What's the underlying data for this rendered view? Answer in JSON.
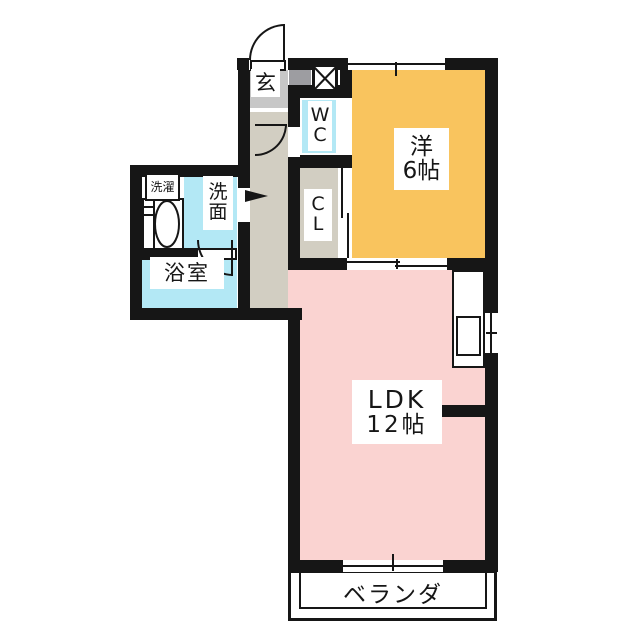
{
  "title": "apartment-floor-plan",
  "rooms": {
    "western": {
      "name": "洋",
      "size": "6帖"
    },
    "ldk": {
      "name": "LDK",
      "size": "12帖"
    },
    "veranda": {
      "label": "ベランダ"
    },
    "genkan": {
      "label": "玄"
    },
    "wc": {
      "line1": "W",
      "line2": "C"
    },
    "closet": {
      "line1": "C",
      "line2": "L"
    },
    "laundry": {
      "label": "洗濯"
    },
    "washroom": {
      "line1": "洗",
      "line2": "面"
    },
    "bathroom": {
      "label": "浴室"
    }
  },
  "icons": {
    "meter_box": "x-cross-box",
    "washing_machine": "drum-ellipse",
    "door_swing": "quarter-arc",
    "entry_direction": "flag-arrow"
  },
  "colors": {
    "wall": "#161616",
    "western": "#F9C45E",
    "ldk": "#FAD3D1",
    "wet": "#B3E8F5",
    "hall": "#D2CEC2",
    "tile": "#C7C7C7",
    "step": "#9D9DA1"
  }
}
